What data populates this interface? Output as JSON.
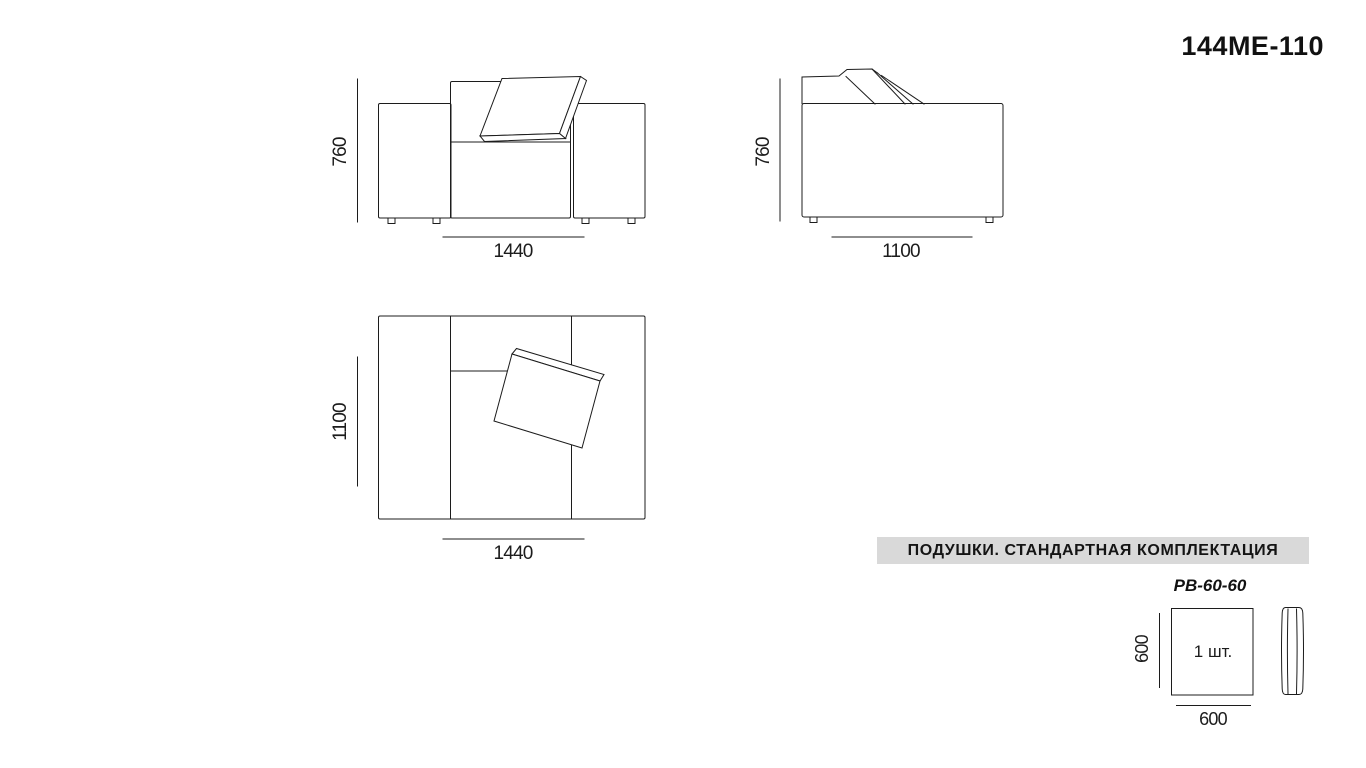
{
  "page": {
    "title": "144МЕ-110"
  },
  "views": {
    "front": {
      "height_dim": "760",
      "width_dim": "1440"
    },
    "side": {
      "height_dim": "760",
      "width_dim": "1100"
    },
    "top": {
      "height_dim": "1100",
      "width_dim": "1440"
    }
  },
  "cushions": {
    "header": "ПОДУШКИ. СТАНДАРТНАЯ КОМПЛЕКТАЦИЯ",
    "model": "РВ-60-60",
    "quantity": "1 шт.",
    "height_dim": "600",
    "width_dim": "600"
  },
  "colors": {
    "line": "#1c1c1c",
    "header_bg": "#d9d9d9",
    "text": "#111111"
  }
}
